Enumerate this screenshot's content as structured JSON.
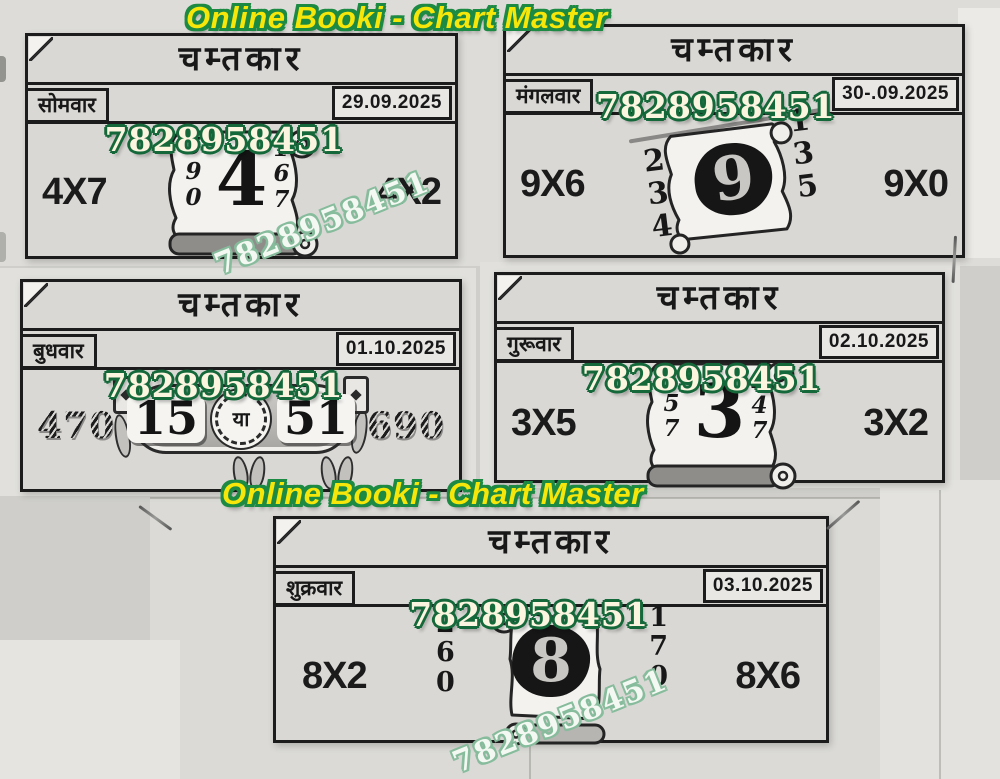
{
  "page": {
    "header_top": "Online Booki  -  Chart  Master",
    "header_mid": "Online Booki  -  Chart  Master",
    "watermark": "7828958451",
    "colors": {
      "header_fill": "#f6e60a",
      "header_outline": "#1d8a43",
      "phone_fill": "#fbf5e0",
      "phone_outline": "#15683a",
      "paper": "#dad8d4",
      "ink": "#1c1c1c"
    }
  },
  "cards": [
    {
      "title": "चम्तकार",
      "day": "सोमवार",
      "date": "29.09.2025",
      "phone": "7828958451",
      "left_code": "4X7",
      "right_code": "4X2",
      "main_number": "4",
      "left_digits": [
        "5",
        "9",
        "0"
      ],
      "right_digits": [
        "1",
        "6",
        "7"
      ]
    },
    {
      "title": "चम्तकार",
      "day": "मंगलवार",
      "date": "30-.09.2025",
      "phone": "7828958451",
      "left_code": "9X6",
      "right_code": "9X0",
      "main_number": "9",
      "left_digits": [
        "2",
        "3",
        "4"
      ],
      "right_digits": [
        "1",
        "3",
        "5"
      ]
    },
    {
      "title": "चम्तकार",
      "day": "बुधवार",
      "date": "01.10.2025",
      "phone": "7828958451",
      "left_code": "470",
      "right_code": "690",
      "banner_left": "15",
      "banner_or": "या",
      "banner_right": "51"
    },
    {
      "title": "चम्तकार",
      "day": "गुरूवार",
      "date": "02.10.2025",
      "phone": "7828958451",
      "left_code": "3X5",
      "right_code": "3X2",
      "main_number": "3",
      "left_digits": [
        "1",
        "5",
        "7"
      ],
      "right_digits": [
        "2",
        "4",
        "7"
      ]
    },
    {
      "title": "चम्तकार",
      "day": "शुक्रवार",
      "date": "03.10.2025",
      "phone": "7828958451",
      "left_code": "8X2",
      "right_code": "8X6",
      "main_number": "8",
      "left_digits": [
        "2",
        "6",
        "0"
      ],
      "right_digits": [
        "1",
        "7",
        "0"
      ]
    }
  ]
}
